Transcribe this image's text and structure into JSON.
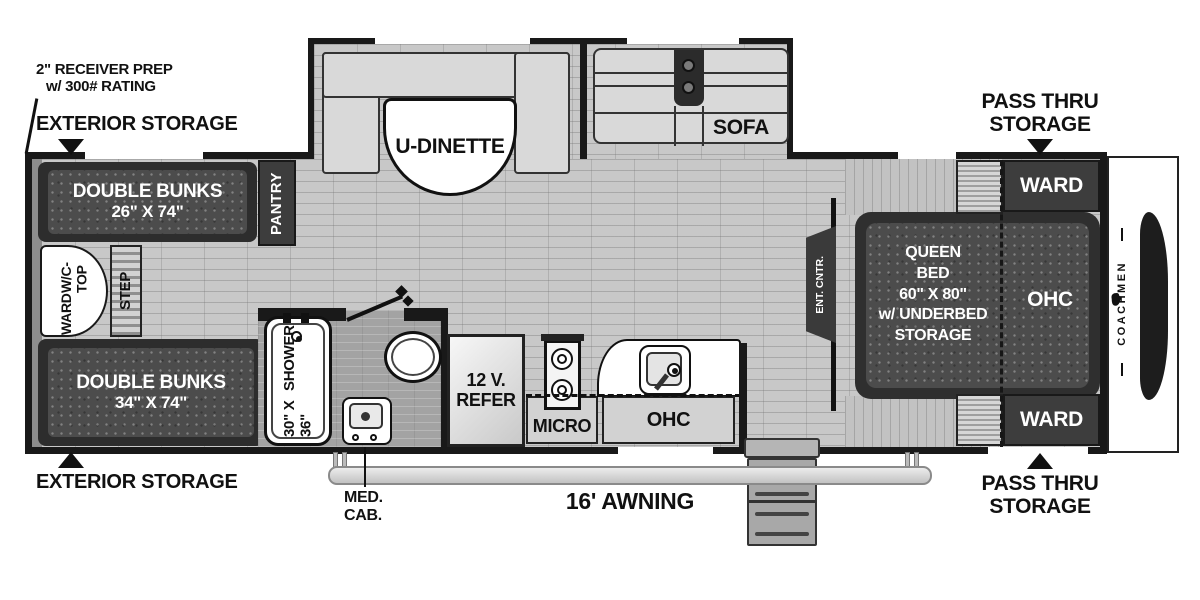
{
  "annotations": {
    "receiver_prep_line1": "2\" RECEIVER PREP",
    "receiver_prep_line2": "w/ 300# RATING",
    "exterior_storage_top": "EXTERIOR STORAGE",
    "exterior_storage_bottom": "EXTERIOR STORAGE",
    "pass_thru_top_line1": "PASS THRU",
    "pass_thru_top_line2": "STORAGE",
    "pass_thru_bottom_line1": "PASS THRU",
    "pass_thru_bottom_line2": "STORAGE",
    "awning": "16' AWNING",
    "med_cab_line1": "MED.",
    "med_cab_line2": "CAB."
  },
  "rooms": {
    "bunk_top_line1": "DOUBLE BUNKS",
    "bunk_top_line2": "26\" X 74\"",
    "bunk_bottom_line1": "DOUBLE BUNKS",
    "bunk_bottom_line2": "34\" X 74\"",
    "pantry": "PANTRY",
    "ward_wc_line1": "WARD",
    "ward_wc_line2": "W/C-TOP",
    "step": "STEP",
    "shower_line1": "30\" X 36\"",
    "shower_line2": "SHOWER",
    "refer_line1": "12 V.",
    "refer_line2": "REFER",
    "micro": "MICRO",
    "ohc_kitchen": "OHC",
    "ent_cntr": "ENT. CNTR.",
    "u_dinette": "U-DINETTE",
    "sofa": "SOFA",
    "queen_line1": "QUEEN",
    "queen_line2": "BED",
    "queen_line3": "60\" X 80\"",
    "queen_line4": "w/ UNDERBED",
    "queen_line5": "STORAGE",
    "ohc_bed": "OHC",
    "ward_top": "WARD",
    "ward_bottom": "WARD"
  },
  "brand": {
    "name": "COACHMEN"
  },
  "colors": {
    "wall": "#191919",
    "floor": "#c8c8c8",
    "dark_furniture": "#3d3d3d",
    "cushion": "#d9d9d9"
  }
}
